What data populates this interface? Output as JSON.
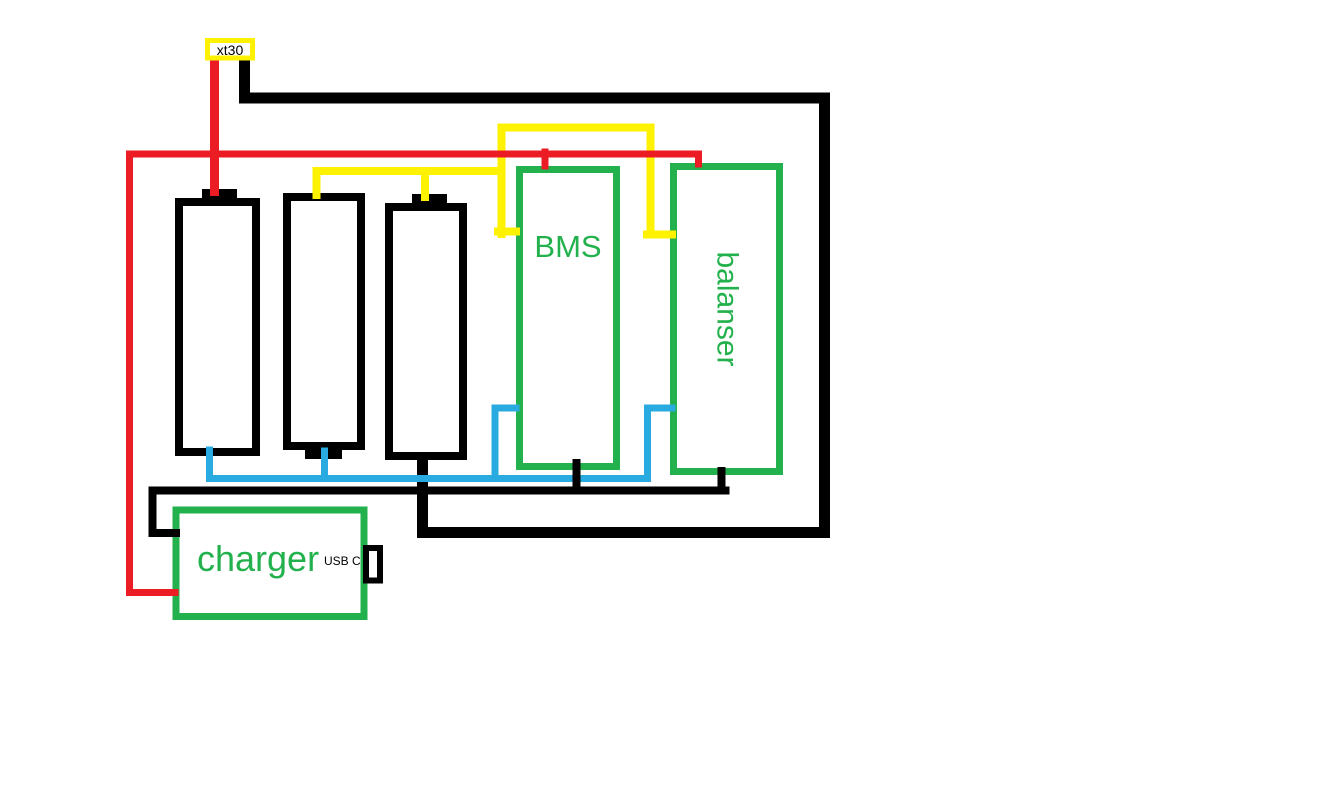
{
  "diagram": {
    "type": "battery-pack-wiring-sketch",
    "battery_cells": 3
  },
  "components": {
    "xt30": {
      "label": "xt30"
    },
    "bms": {
      "label": "BMS"
    },
    "balancer": {
      "label": "balanser"
    },
    "charger": {
      "label": "charger"
    },
    "usb": {
      "label": "USB C"
    }
  },
  "colors": {
    "red": "#ec1c24",
    "yellow": "#fff200",
    "green": "#22b14c",
    "blue": "#29abe2",
    "black": "#000000",
    "white": "#ffffff",
    "background": "#ffffff"
  }
}
